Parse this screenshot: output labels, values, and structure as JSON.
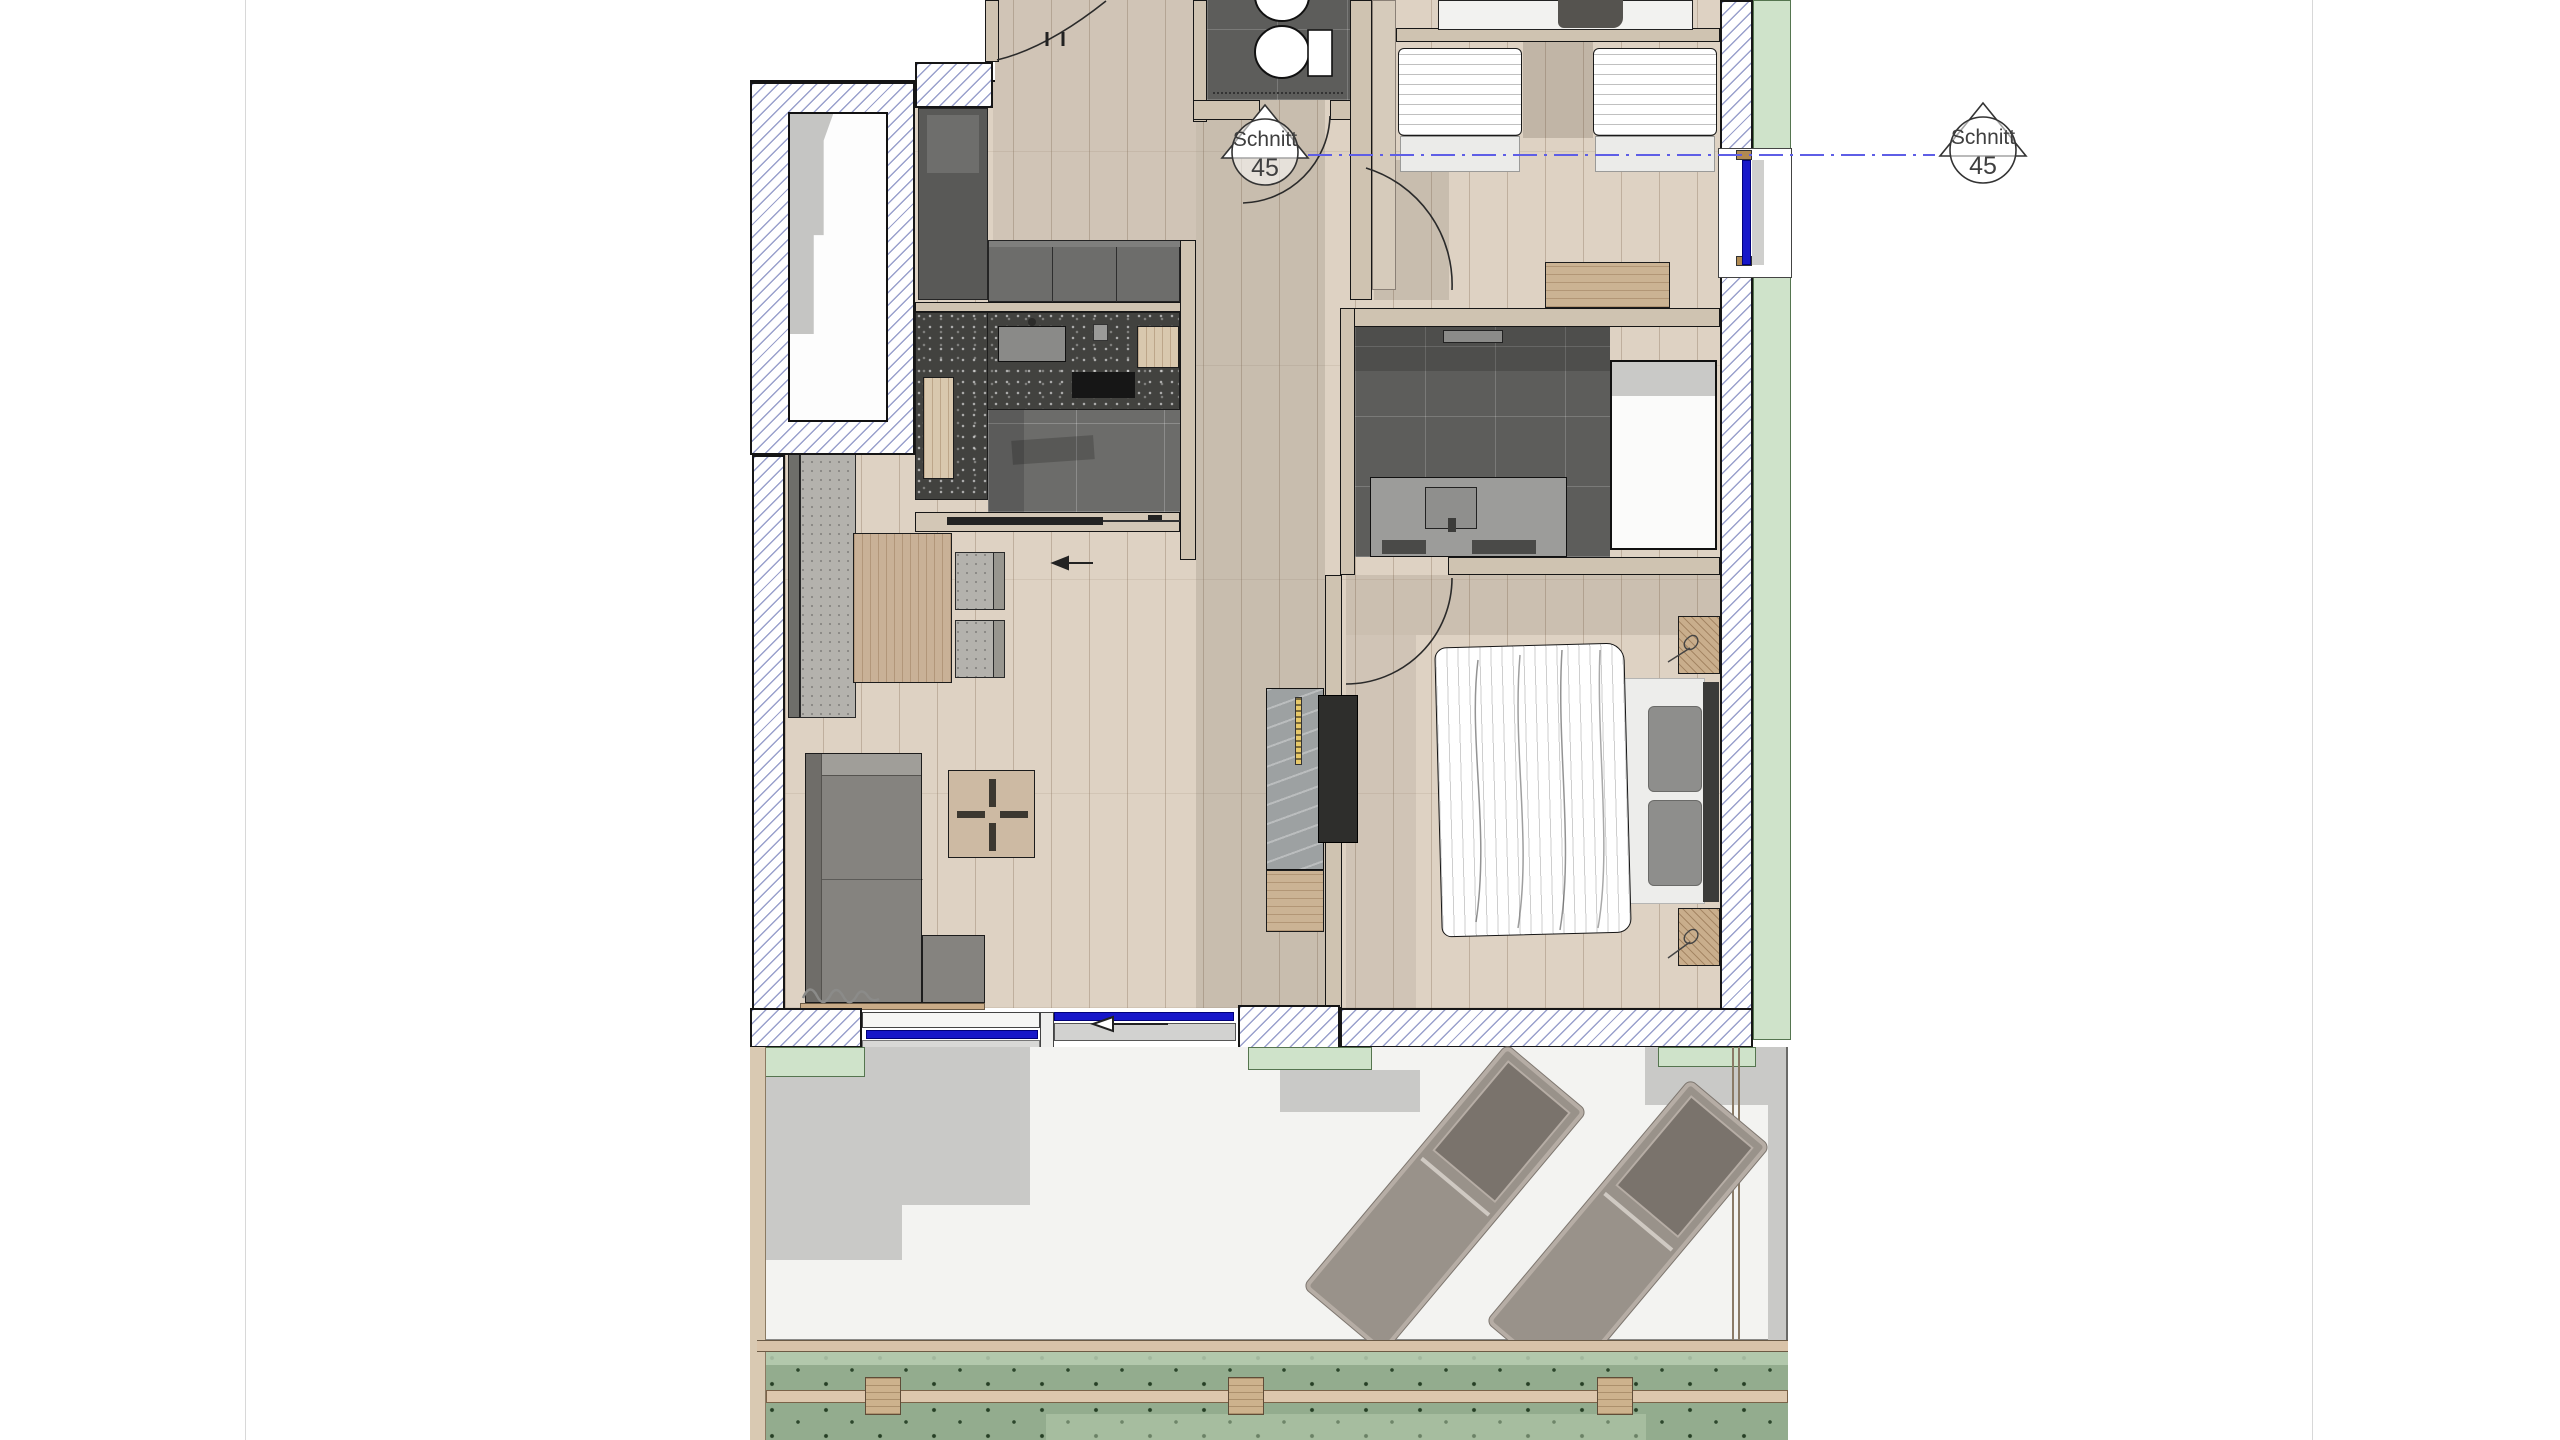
{
  "section_markers": {
    "left": {
      "label": "Schnitt",
      "number": "45"
    },
    "right": {
      "label": "Schnitt",
      "number": "45"
    }
  },
  "palette": {
    "paper": "#ffffff",
    "page_line": "#d8d8d8",
    "wood_floor": "#ded2c3",
    "tile_floor": "#6c6c6a",
    "tile_dark": "#5d5d5b",
    "wall_beige": "#cfc3b1",
    "line_black": "#161616",
    "hatch_line": "#99a0cc",
    "counter_dark": "#42423f",
    "cabinet_dark": "#595957",
    "cabinet_mid": "#6d6d6b",
    "glass_blue": "#1717c9",
    "section_blue": "#5e5ee6",
    "green_edge": "#cfe3ca",
    "plant_green": "#93ac8e",
    "plant_light": "#b7ccb1",
    "terrace_floor": "#f3f3f1",
    "shadow_gray": "#c9c9c7",
    "wood_warm": "#c9b197",
    "wood_post": "#cdb28d",
    "sofa_gray": "#85837f",
    "cushion_dark": "#7a736c",
    "lounger_body": "#99928a",
    "lounger_frame": "#b6ada5",
    "white_fixture": "#fbfbfa",
    "headboard_dark": "#3b3b39",
    "pillow_gray": "#8e8e8c",
    "marble_gray": "#9da1a2",
    "marker_text": "#3f3f3f"
  }
}
